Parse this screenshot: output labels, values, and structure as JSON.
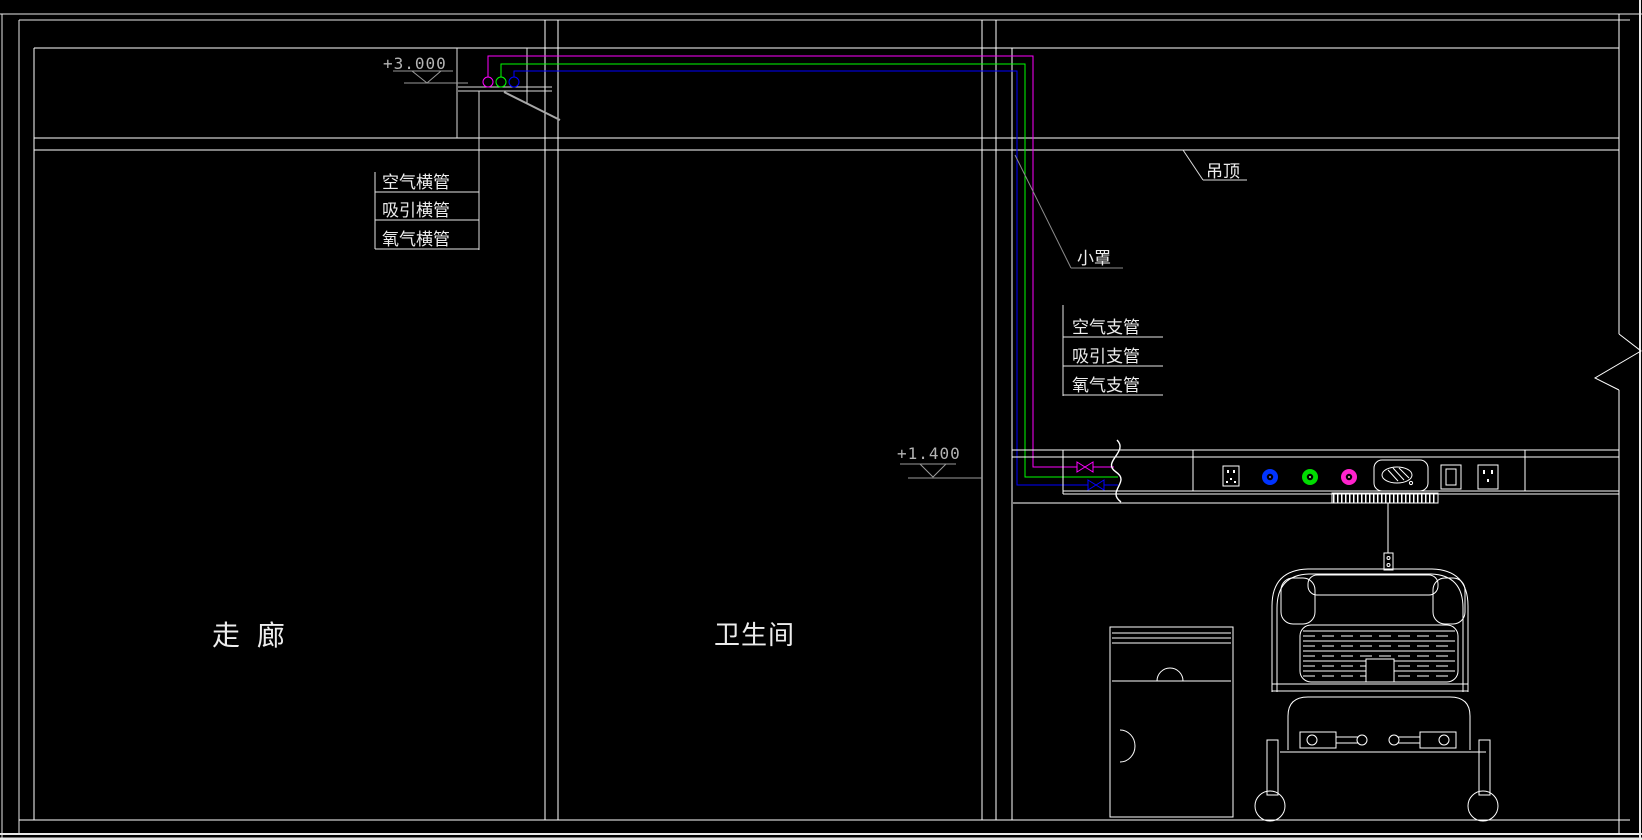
{
  "drawing": {
    "type": "CAD elevation section - hospital ward medical gas piping",
    "background": "#000000"
  },
  "labels": {
    "elevation_ceiling": "+3.000",
    "elevation_outlet": "+1.400",
    "horizontal_pipes": [
      "空气横管",
      "吸引横管",
      "氧气横管"
    ],
    "branch_pipes": [
      "空气支管",
      "吸引支管",
      "氧气支管"
    ],
    "ceiling": "吊顶",
    "small_cover": "小罩",
    "room_corridor": "走 廊",
    "room_bathroom": "卫生间"
  },
  "colors": {
    "line": "#ffffff",
    "dim_line": "#9a9a9a",
    "pipe_magenta": "#ff00ff",
    "pipe_green": "#00ff00",
    "pipe_blue": "#0000ff",
    "outlet_blue": "#0033ff",
    "outlet_green": "#00dd00",
    "outlet_magenta": "#ff22cc"
  }
}
